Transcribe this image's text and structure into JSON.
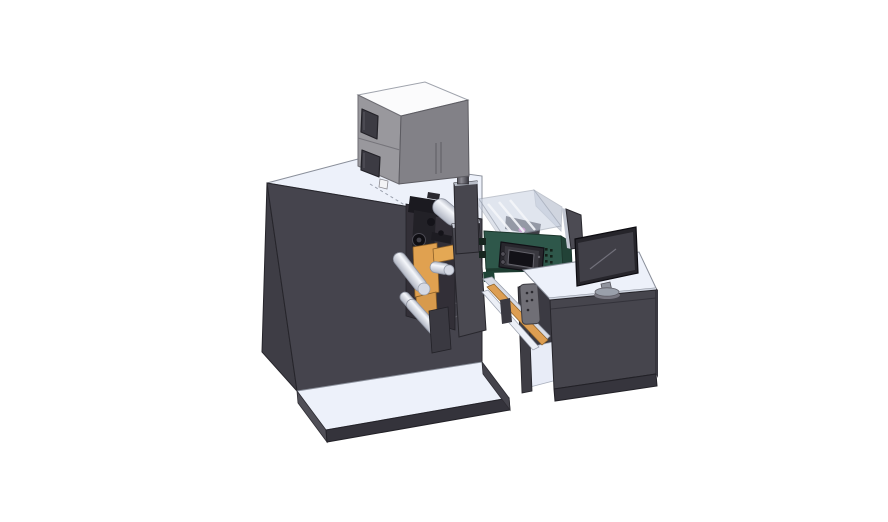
{
  "meta": {
    "title": "Isometric CAD render of a compact label printing press with feeder box, glass-enclosed print unit, outfeed desk and monitor",
    "canvas": {
      "width": 888,
      "height": 522
    },
    "background": "#ffffff"
  },
  "palette": {
    "surface_light": "#edf1fa",
    "machine_front": "#45444d",
    "machine_left": "#3e3d45",
    "recess": "#322f37",
    "slab": "#4a4951",
    "box_top": "#fbfbfc",
    "box_front": "#99989d",
    "box_right": "#828187",
    "window_dark": "#3c3b43",
    "orange": "#e0a150",
    "green_panel": "#2e574a",
    "green_side": "#224237",
    "glass_top": "#cdd5e4",
    "magenta": "#c45ab8",
    "monitor_bezel": "#26252b",
    "monitor_screen": "#403f47",
    "desk_front": "#46454d",
    "desk_base": "#36353d",
    "platform_front": "#34333b",
    "bracket_gray": "#706f76",
    "chute_light": "#d7dbe5",
    "panel_body": "#28272d",
    "panel_screen": "#121117",
    "tower": "#47464e",
    "deflector": "#4c4b53",
    "outline": "#26252b"
  },
  "parts": [
    {
      "id": "base-platform",
      "label": "machine base platform"
    },
    {
      "id": "main-machine",
      "label": "main press cabinet"
    },
    {
      "id": "feeder-box",
      "label": "gray feeder / dryer box"
    },
    {
      "id": "exhaust-cylinder",
      "label": "exhaust stack cylinder"
    },
    {
      "id": "web-path-bay",
      "label": "web path bay with rollers"
    },
    {
      "id": "print-head-mechanism",
      "label": "print head mechanism"
    },
    {
      "id": "glass-enclosure",
      "label": "transparent print unit enclosure"
    },
    {
      "id": "control-panel",
      "label": "operator control panel with screen"
    },
    {
      "id": "outfeed-chute",
      "label": "outfeed chute"
    },
    {
      "id": "operator-desk",
      "label": "operator desk with open shelf"
    },
    {
      "id": "monitor",
      "label": "desktop monitor"
    },
    {
      "id": "monitor-deflector-panel",
      "label": "side deflector panel"
    }
  ]
}
